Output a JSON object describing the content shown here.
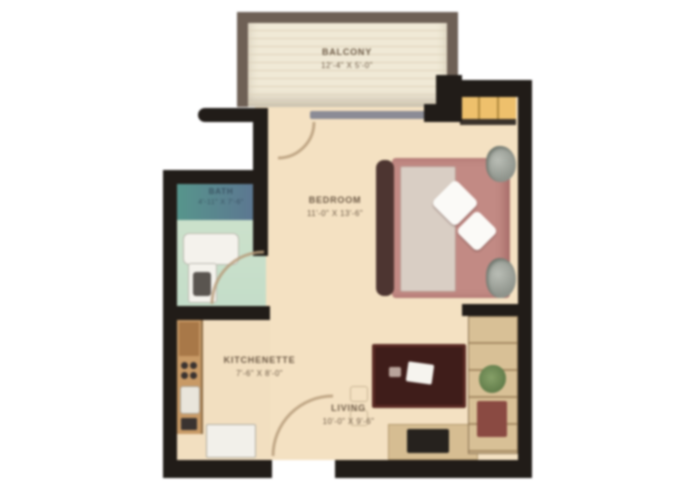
{
  "title": "apartment-floor-plan",
  "rooms": {
    "balcony": {
      "name": "BALCONY",
      "dims": "12'-4\" X 5'-0\""
    },
    "bedroom": {
      "name": "BEDROOM",
      "dims": "11'-0\" X 13'-6\""
    },
    "bath": {
      "name": "BATH",
      "dims": "4'-11\" X 7'-6\""
    },
    "kitchenette": {
      "name": "KITCHENETTE",
      "dims": "7'-6\" X 8'-0\""
    },
    "living": {
      "name": "LIVING",
      "dims": "10'-0\" X 9'-6\""
    }
  },
  "colors": {
    "wall": "#211c18",
    "floor": "#f4e1c2",
    "balcony_wall": "#6e6055",
    "bath_floor": "#cfe3cc",
    "bath_tile": "#57958c",
    "closet": "#eec06c",
    "bed_linen": "#c28a84",
    "duvet": "#d9cec4",
    "table": "#3f1d1a",
    "shelf": "#d8c096",
    "kitchen_counter": "#c89a66",
    "glass_slider": "#8b8c96",
    "door_arc": "#b79d7c"
  },
  "furniture": [
    "bed",
    "pillows",
    "plants",
    "closet",
    "wardrobe-shelf",
    "coffee-table",
    "laptop",
    "tv-console",
    "tv",
    "kitchen-counter",
    "stove",
    "sink",
    "refrigerator",
    "vanity",
    "toilet",
    "chairs"
  ]
}
